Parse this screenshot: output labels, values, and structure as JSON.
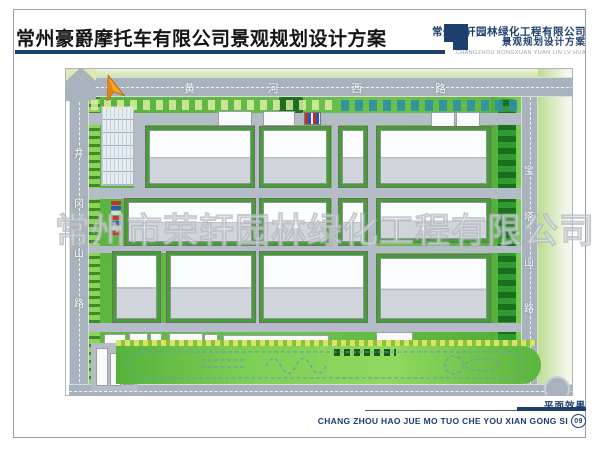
{
  "header": {
    "title": "常州豪爵摩托车有限公司景观规划设计方案",
    "company": {
      "name_cn": "常州荣轩园林绿化工程有限公司",
      "subtitle_cn": "景观规划设计方案",
      "name_pinyin": "CHANGZHOU RONGXUAN YUAN LIN LV HUA"
    }
  },
  "plan": {
    "watermark": "常州市荣轩园林绿化工程有限公司",
    "roads": {
      "top": "黄河西路",
      "left": "井冈山路",
      "right": "宝塔山路"
    },
    "compass": "north-arrow"
  },
  "footer": {
    "sheet_label": "平面效果",
    "company_pinyin": "CHANG ZHOU HAO JUE MO TUO CHE YOU XIAN GONG SI",
    "page_number": "09"
  },
  "colors": {
    "accent_navy": "#1c3f6e",
    "road_gray": "#a9b3bd",
    "lawn_green": "#5cb53e",
    "hedge_green": "#3c8a2a",
    "building_roof": "#fbfcfd",
    "building_base": "#d0d5db",
    "compass_orange": "#f0a020",
    "teal_parking_stall": "#2e8fa8",
    "flower_dot_purple": "#9b3d9b"
  }
}
